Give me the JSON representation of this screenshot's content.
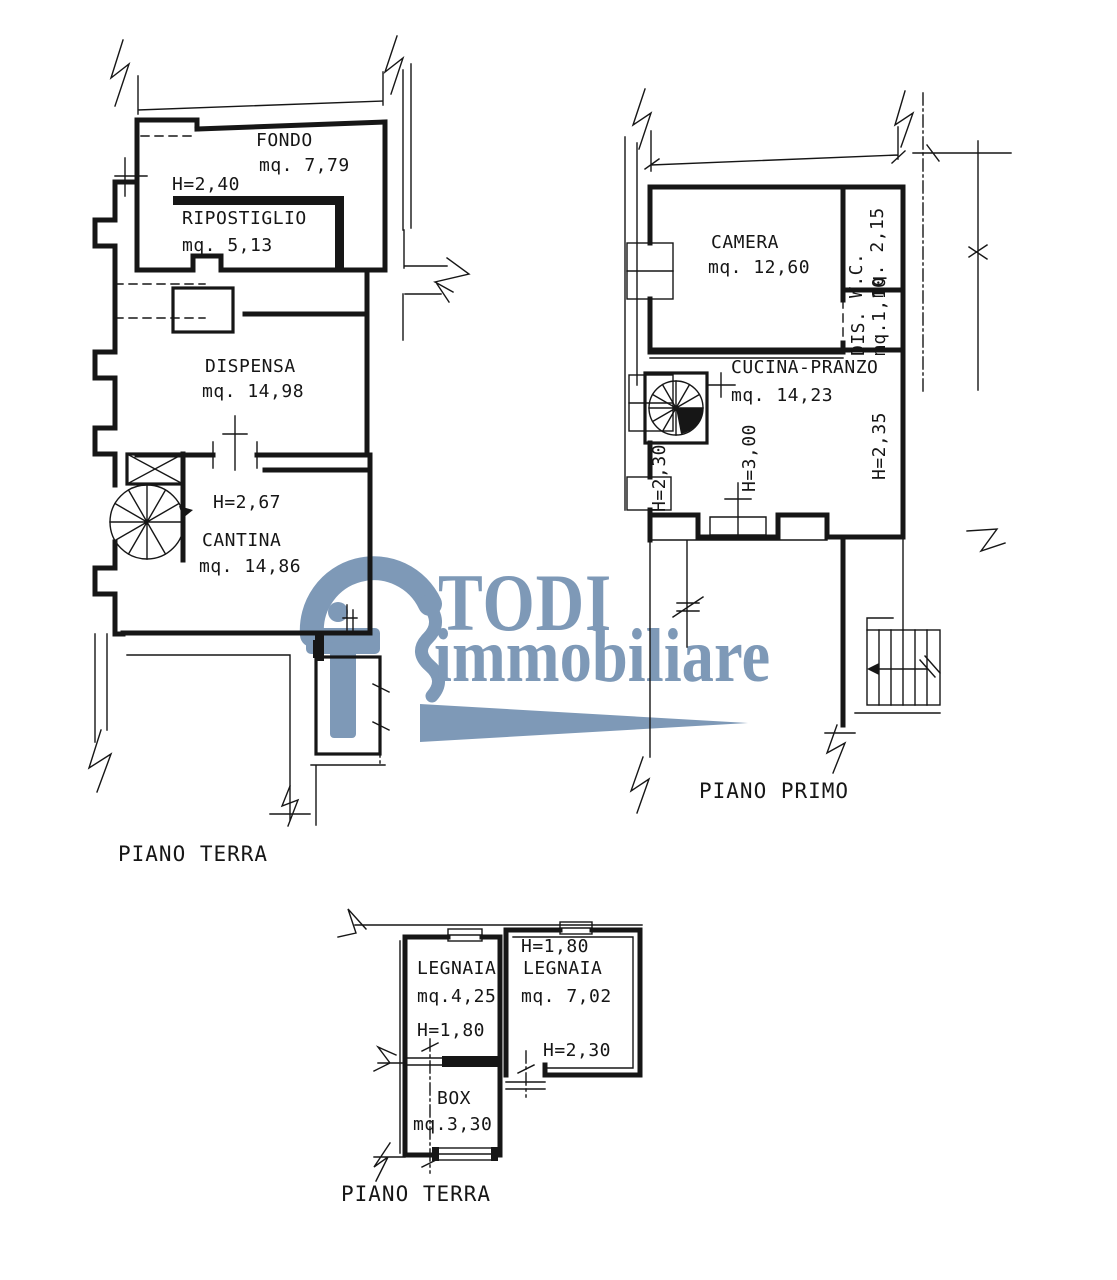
{
  "ink": "#161616",
  "watermark": {
    "title": "TODI",
    "subtitle": "immobiliare",
    "color": "#6283a8"
  },
  "plans": {
    "ground": {
      "caption": "PIANO TERRA",
      "fondo_name": "FONDO",
      "fondo_area": "mq. 7,79",
      "ripostiglio_height": "H=2,40",
      "ripostiglio_name": "RIPOSTIGLIO",
      "ripostiglio_area": "mq. 5,13",
      "dispensa_name": "DISPENSA",
      "dispensa_area": "mq. 14,98",
      "cantina_height": "H=2,67",
      "cantina_name": "CANTINA",
      "cantina_area": "mq. 14,86"
    },
    "first": {
      "caption": "PIANO PRIMO",
      "camera_name": "CAMERA",
      "camera_area": "mq. 12,60",
      "wc_label": "W.C.\nmq. 2,15",
      "dis_label": "DIS.\nmq.1,10",
      "cucina_name": "CUCINA-PRANZO",
      "cucina_area": "mq. 14,23",
      "cucina_height": "H=3,00",
      "height_left": "H=2,30",
      "height_right": "H=2,35"
    },
    "annex": {
      "caption": "PIANO TERRA",
      "legnaia_left_name": "LEGNAIA",
      "legnaia_left_area": "mq.4,25",
      "legnaia_left_height": "H=1,80",
      "legnaia_right_height_top": "H=1,80",
      "legnaia_right_name": "LEGNAIA",
      "legnaia_right_area": "mq. 7,02",
      "legnaia_right_height_bottom": "H=2,30",
      "box_name": "BOX",
      "box_area": "mq.3,30"
    }
  }
}
